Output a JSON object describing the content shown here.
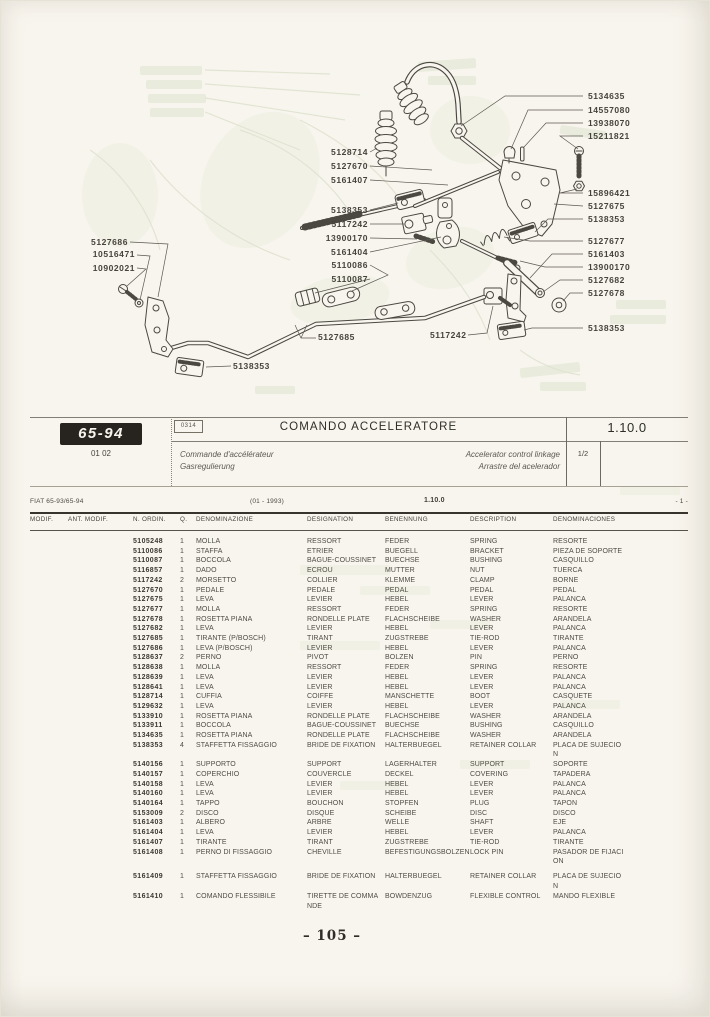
{
  "title_block": {
    "model_badge": "65-94",
    "model_sub": "01 02",
    "code_box": "0314",
    "title": "COMANDO ACCELERATORE",
    "subtitle_fr": "Commande d'accélérateur",
    "subtitle_de": "Gasregulierung",
    "subtitle_en": "Accelerator control linkage",
    "subtitle_es": "Arrastre del acelerador",
    "section_number": "1.10.0",
    "sheet": "1/2"
  },
  "info_strip": {
    "model_range": "FIAT 65-93/65-94",
    "date": "(01 - 1993)",
    "section": "1.10.0",
    "page_ref": "- 1 -"
  },
  "table": {
    "headers": [
      "MODIF.",
      "ANT. MODIF.",
      "N. ORDIN.",
      "Q.",
      "DENOMINAZIONE",
      "DESIGNATION",
      "BENENNUNG",
      "DESCRIPTION",
      "DENOMINACIONES"
    ],
    "gap_before": "5161409",
    "rows": [
      {
        "n": "5105248",
        "q": "1",
        "it": "MOLLA",
        "fr": "RESSORT",
        "de": "FEDER",
        "en": "SPRING",
        "es": "RESORTE"
      },
      {
        "n": "5110086",
        "q": "1",
        "it": "STAFFA",
        "fr": "ETRIER",
        "de": "BUEGELL",
        "en": "BRACKET",
        "es": "PIEZA DE SOPORTE"
      },
      {
        "n": "5110087",
        "q": "1",
        "it": "BOCCOLA",
        "fr": "BAGUE-COUSSINET",
        "de": "BUECHSE",
        "en": "BUSHING",
        "es": "CASQUILLO"
      },
      {
        "n": "5116857",
        "q": "1",
        "it": "DADO",
        "fr": "ECROU",
        "de": "MUTTER",
        "en": "NUT",
        "es": "TUERCA"
      },
      {
        "n": "5117242",
        "q": "2",
        "it": "MORSETTO",
        "fr": "COLLIER",
        "de": "KLEMME",
        "en": "CLAMP",
        "es": "BORNE"
      },
      {
        "n": "5127670",
        "q": "1",
        "it": "PEDALE",
        "fr": "PEDALE",
        "de": "PEDAL",
        "en": "PEDAL",
        "es": "PEDAL"
      },
      {
        "n": "5127675",
        "q": "1",
        "it": "LEVA",
        "fr": "LEVIER",
        "de": "HEBEL",
        "en": "LEVER",
        "es": "PALANCA"
      },
      {
        "n": "5127677",
        "q": "1",
        "it": "MOLLA",
        "fr": "RESSORT",
        "de": "FEDER",
        "en": "SPRING",
        "es": "RESORTE"
      },
      {
        "n": "5127678",
        "q": "1",
        "it": "ROSETTA PIANA",
        "fr": "RONDELLE PLATE",
        "de": "FLACHSCHEIBE",
        "en": "WASHER",
        "es": "ARANDELA"
      },
      {
        "n": "5127682",
        "q": "1",
        "it": "LEVA",
        "fr": "LEVIER",
        "de": "HEBEL",
        "en": "LEVER",
        "es": "PALANCA"
      },
      {
        "n": "5127685",
        "q": "1",
        "it": "TIRANTE (P/BOSCH)",
        "fr": "TIRANT",
        "de": "ZUGSTREBE",
        "en": "TIE-ROD",
        "es": "TIRANTE"
      },
      {
        "n": "5127686",
        "q": "1",
        "it": "LEVA (P/BOSCH)",
        "fr": "LEVIER",
        "de": "HEBEL",
        "en": "LEVER",
        "es": "PALANCA"
      },
      {
        "n": "5128637",
        "q": "2",
        "it": "PERNO",
        "fr": "PIVOT",
        "de": "BOLZEN",
        "en": "PIN",
        "es": "PERNO"
      },
      {
        "n": "5128638",
        "q": "1",
        "it": "MOLLA",
        "fr": "RESSORT",
        "de": "FEDER",
        "en": "SPRING",
        "es": "RESORTE"
      },
      {
        "n": "5128639",
        "q": "1",
        "it": "LEVA",
        "fr": "LEVIER",
        "de": "HEBEL",
        "en": "LEVER",
        "es": "PALANCA"
      },
      {
        "n": "5128641",
        "q": "1",
        "it": "LEVA",
        "fr": "LEVIER",
        "de": "HEBEL",
        "en": "LEVER",
        "es": "PALANCA"
      },
      {
        "n": "5128714",
        "q": "1",
        "it": "CUFFIA",
        "fr": "COIFFE",
        "de": "MANSCHETTE",
        "en": "BOOT",
        "es": "CASQUETE"
      },
      {
        "n": "5129632",
        "q": "1",
        "it": "LEVA",
        "fr": "LEVIER",
        "de": "HEBEL",
        "en": "LEVER",
        "es": "PALANCA"
      },
      {
        "n": "5133910",
        "q": "1",
        "it": "ROSETTA PIANA",
        "fr": "RONDELLE PLATE",
        "de": "FLACHSCHEIBE",
        "en": "WASHER",
        "es": "ARANDELA"
      },
      {
        "n": "5133911",
        "q": "1",
        "it": "BOCCOLA",
        "fr": "BAGUE-COUSSINET",
        "de": "BUECHSE",
        "en": "BUSHING",
        "es": "CASQUILLO"
      },
      {
        "n": "5134635",
        "q": "1",
        "it": "ROSETTA PIANA",
        "fr": "RONDELLE PLATE",
        "de": "FLACHSCHEIBE",
        "en": "WASHER",
        "es": "ARANDELA"
      },
      {
        "n": "5138353",
        "q": "4",
        "it": "STAFFETTA FISSAGGIO",
        "fr": "BRIDE DE FIXATION",
        "de": "HALTERBUEGEL",
        "en": "RETAINER COLLAR",
        "es": "PLACA DE SUJECION"
      },
      {
        "n": "5140156",
        "q": "1",
        "it": "SUPPORTO",
        "fr": "SUPPORT",
        "de": "LAGERHALTER",
        "en": "SUPPORT",
        "es": "SOPORTE"
      },
      {
        "n": "5140157",
        "q": "1",
        "it": "COPERCHIO",
        "fr": "COUVERCLE",
        "de": "DECKEL",
        "en": "COVERING",
        "es": "TAPADERA"
      },
      {
        "n": "5140158",
        "q": "1",
        "it": "LEVA",
        "fr": "LEVIER",
        "de": "HEBEL",
        "en": "LEVER",
        "es": "PALANCA"
      },
      {
        "n": "5140160",
        "q": "1",
        "it": "LEVA",
        "fr": "LEVIER",
        "de": "HEBEL",
        "en": "LEVER",
        "es": "PALANCA"
      },
      {
        "n": "5140164",
        "q": "1",
        "it": "TAPPO",
        "fr": "BOUCHON",
        "de": "STOPFEN",
        "en": "PLUG",
        "es": "TAPON"
      },
      {
        "n": "5153009",
        "q": "2",
        "it": "DISCO",
        "fr": "DISQUE",
        "de": "SCHEIBE",
        "en": "DISC",
        "es": "DISCO"
      },
      {
        "n": "5161403",
        "q": "1",
        "it": "ALBERO",
        "fr": "ARBRE",
        "de": "WELLE",
        "en": "SHAFT",
        "es": "EJE"
      },
      {
        "n": "5161404",
        "q": "1",
        "it": "LEVA",
        "fr": "LEVIER",
        "de": "HEBEL",
        "en": "LEVER",
        "es": "PALANCA"
      },
      {
        "n": "5161407",
        "q": "1",
        "it": "TIRANTE",
        "fr": "TIRANT",
        "de": "ZUGSTREBE",
        "en": "TIE-ROD",
        "es": "TIRANTE"
      },
      {
        "n": "5161408",
        "q": "1",
        "it": "PERNO DI FISSAGGIO",
        "fr": "CHEVILLE",
        "de": "BEFESTIGUNGSBOLZEN",
        "en": "LOCK PIN",
        "es": "PASADOR DE FIJACION"
      },
      {
        "n": "5161409",
        "q": "1",
        "it": "STAFFETTA FISSAGGIO",
        "fr": "BRIDE DE FIXATION",
        "de": "HALTERBUEGEL",
        "en": "RETAINER COLLAR",
        "es": "PLACA DE SUJECION"
      },
      {
        "n": "5161410",
        "q": "1",
        "it": "COMANDO FLESSIBILE",
        "fr": "TIRETTE DE COMMANDE",
        "de": "BOWDENZUG",
        "en": "FLEXIBLE CONTROL",
        "es": "MANDO FLEXIBLE"
      }
    ]
  },
  "diagram": {
    "labels": [
      {
        "text": "5134635",
        "x": 588,
        "y": 92,
        "anchor": "start"
      },
      {
        "text": "14557080",
        "x": 588,
        "y": 106,
        "anchor": "start"
      },
      {
        "text": "13938070",
        "x": 588,
        "y": 119,
        "anchor": "start"
      },
      {
        "text": "15211821",
        "x": 588,
        "y": 132,
        "anchor": "start"
      },
      {
        "text": "15896421",
        "x": 588,
        "y": 189,
        "anchor": "start"
      },
      {
        "text": "5127675",
        "x": 588,
        "y": 202,
        "anchor": "start"
      },
      {
        "text": "5138353",
        "x": 588,
        "y": 215,
        "anchor": "start"
      },
      {
        "text": "5127677",
        "x": 588,
        "y": 237,
        "anchor": "start"
      },
      {
        "text": "5161403",
        "x": 588,
        "y": 250,
        "anchor": "start"
      },
      {
        "text": "13900170",
        "x": 588,
        "y": 263,
        "anchor": "start"
      },
      {
        "text": "5127682",
        "x": 588,
        "y": 276,
        "anchor": "start"
      },
      {
        "text": "5127678",
        "x": 588,
        "y": 289,
        "anchor": "start"
      },
      {
        "text": "5138353",
        "x": 588,
        "y": 324,
        "anchor": "start"
      },
      {
        "text": "5128714",
        "x": 368,
        "y": 148,
        "anchor": "end"
      },
      {
        "text": "5127670",
        "x": 368,
        "y": 162,
        "anchor": "end"
      },
      {
        "text": "5161407",
        "x": 368,
        "y": 176,
        "anchor": "end"
      },
      {
        "text": "5138353",
        "x": 368,
        "y": 206,
        "anchor": "end"
      },
      {
        "text": "5117242",
        "x": 368,
        "y": 220,
        "anchor": "end"
      },
      {
        "text": "13900170",
        "x": 368,
        "y": 234,
        "anchor": "end"
      },
      {
        "text": "5161404",
        "x": 368,
        "y": 248,
        "anchor": "end"
      },
      {
        "text": "5110086",
        "x": 368,
        "y": 261,
        "anchor": "end"
      },
      {
        "text": "5110087",
        "x": 368,
        "y": 275,
        "anchor": "end"
      },
      {
        "text": "5127686",
        "x": 128,
        "y": 238,
        "anchor": "end"
      },
      {
        "text": "10516471",
        "x": 135,
        "y": 250,
        "anchor": "end"
      },
      {
        "text": "10902021",
        "x": 135,
        "y": 264,
        "anchor": "end"
      },
      {
        "text": "5127685",
        "x": 318,
        "y": 333,
        "anchor": "start"
      },
      {
        "text": "5117242",
        "x": 430,
        "y": 331,
        "anchor": "start"
      },
      {
        "text": "5138353",
        "x": 233,
        "y": 362,
        "anchor": "start"
      }
    ]
  },
  "footer": {
    "page_number": "– 105 –"
  }
}
